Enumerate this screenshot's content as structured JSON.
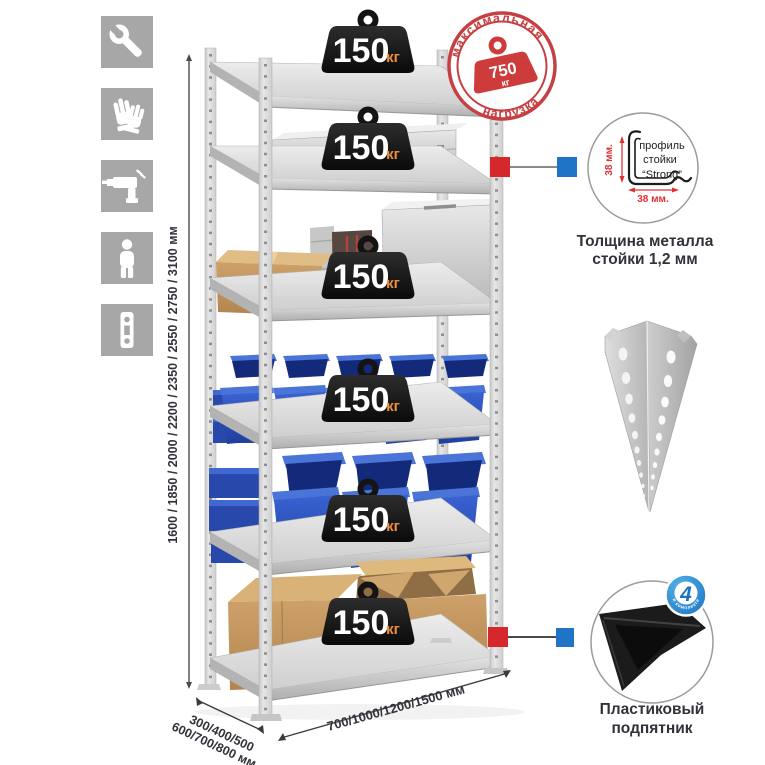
{
  "colors": {
    "accent_red": "#d5282c",
    "accent_blue": "#1f74c8",
    "stamp_red": "#c64043",
    "weight_black": "#161616",
    "weight_unit_orange": "#ef8f3b",
    "bin_blue": "#2e56c0",
    "cardboard": "#c79e66",
    "metal_light": "#dcdcdc",
    "icon_gray": "#a7a7a7",
    "text_dark": "#32323a",
    "dim_red": "#e03131"
  },
  "left_icons": [
    {
      "name": "wrench-icon"
    },
    {
      "name": "gloves-icon"
    },
    {
      "name": "drill-icon"
    },
    {
      "name": "person-icon"
    },
    {
      "name": "perforated-strip-icon"
    }
  ],
  "dimensions": {
    "height_label": "1600 / 1850 / 2000 / 2200 / 2350 / 2550 / 2750 / 3100 мм",
    "depth_label_line1": "300/400/500",
    "depth_label_line2": "600/700/800 мм",
    "width_label": "700/1000/1200/1500 мм"
  },
  "rack": {
    "shelf_weights": [
      {
        "value": "150",
        "unit": "кг"
      },
      {
        "value": "150",
        "unit": "кг"
      },
      {
        "value": "150",
        "unit": "кг"
      },
      {
        "value": "150",
        "unit": "кг"
      },
      {
        "value": "150",
        "unit": "кг"
      },
      {
        "value": "150",
        "unit": "кг"
      }
    ]
  },
  "max_load_stamp": {
    "arc_top": "максимальная",
    "arc_bottom": "нагрузка",
    "value": "750",
    "unit": "кг"
  },
  "profile_detail": {
    "label_line1": "профиль",
    "label_line2": "стойки",
    "label_line3": "“Strong”",
    "vertical_dim": "38 мм.",
    "horizontal_dim": "38 мм.",
    "caption_line1": "Толщина металла",
    "caption_line2": "стойки 1,2 мм"
  },
  "foot_detail": {
    "badge_value": "4",
    "badge_text": "в комплекте",
    "caption_line1": "Пластиковый",
    "caption_line2": "подпятник"
  }
}
